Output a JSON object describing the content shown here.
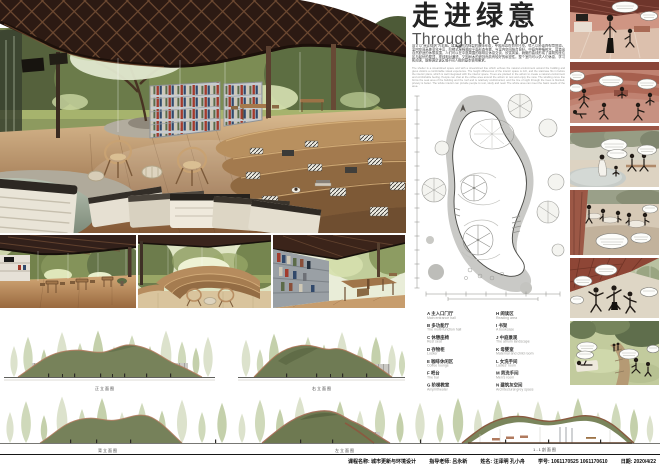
{
  "poster": {
    "title_cn": "走进绿意",
    "title_en": "Through the Arbor",
    "para_cn": "设计以“穿过绿荫”为主题。建筑采用流线型的曲线形态，呼应周边的自然环境，给人以舒适的视觉体验。室内空间高差变化丰富，阶梯式座椅顺应平面形态布置，与室内空间结合良好。中庭内种植树木，营造出自然舒适的休憩氛围，人们可以在中庭周围的咖啡区休息交谈、欣赏风景。蜿蜒的曲线形成了建筑的座位区与起伏的屋顶，视线相对通透，又因树木的遮挡而具有较好的私密性。整个室内可以供人们休息、学习和阅读，能够满足该区域不同人群的基本使用需求。",
    "para_en": "The shelter is a streamlined space and with a streamlined line which echoes the natural environment around the building and gives visitors a comfortable visual experience. The height differences of the interior space is rich, and the staircase fits in before the interior plans, which is well integrated with the interior space. Trees are planted in the atrium to create a natural environment and comfortable feeling. People can chat at the coffee area around the atrium to rest and enjoy the view. The winding curve line forms the seat area of the building and the roof and is relatively unobstructed, and the line of sight through the trees is blocked, privacy is better. The whole interior can provide people to rest, study and read. The whole area can meet the basic needs of the area."
  },
  "plan": {
    "legend_left": [
      {
        "cn": "A 主入口门厅",
        "en": "Main entrance hall"
      },
      {
        "cn": "B 多功能厅",
        "en": "The multi-function hall"
      },
      {
        "cn": "C 休憩座椅",
        "en": "Rest seat"
      },
      {
        "cn": "D 存物柜",
        "en": "Locker"
      },
      {
        "cn": "E 咖啡休闲区",
        "en": "Coffee lounge"
      },
      {
        "cn": "F 吧台",
        "en": "The bar"
      },
      {
        "cn": "G 阶梯教室",
        "en": "Amphitheater"
      }
    ],
    "legend_right": [
      {
        "cn": "H 阅读区",
        "en": "Reading area"
      },
      {
        "cn": "I 书架",
        "en": "A bookcase"
      },
      {
        "cn": "J 中庭景观",
        "en": "The atrium landscape"
      },
      {
        "cn": "K 母婴室",
        "en": "Maternal and child room"
      },
      {
        "cn": "L 女洗手间",
        "en": "Ladies' room"
      },
      {
        "cn": "M 男洗手间",
        "en": "Men's room"
      },
      {
        "cn": "N 建筑灰空间",
        "en": "Architectural grey space"
      }
    ]
  },
  "labels": {
    "elev_front": "正立面图",
    "elev_right": "右立面图",
    "elev_back": "背立面图",
    "elev_left": "左立面图",
    "section": "1-1剖面图"
  },
  "footer": {
    "items": [
      "课程名称: 城市更新与环境设计",
      "指导老师: 吕永新",
      "姓名: 汪泽明 孔小舟",
      "学号: 1061170525 1061170610",
      "日期: 2020/4/22"
    ]
  },
  "colors": {
    "roof_dark": "#2c1a13",
    "terracotta": "#b5826a",
    "elevation_green": "#76815a",
    "comic_salmon": "#c58878",
    "wood": "#a37a4e"
  }
}
